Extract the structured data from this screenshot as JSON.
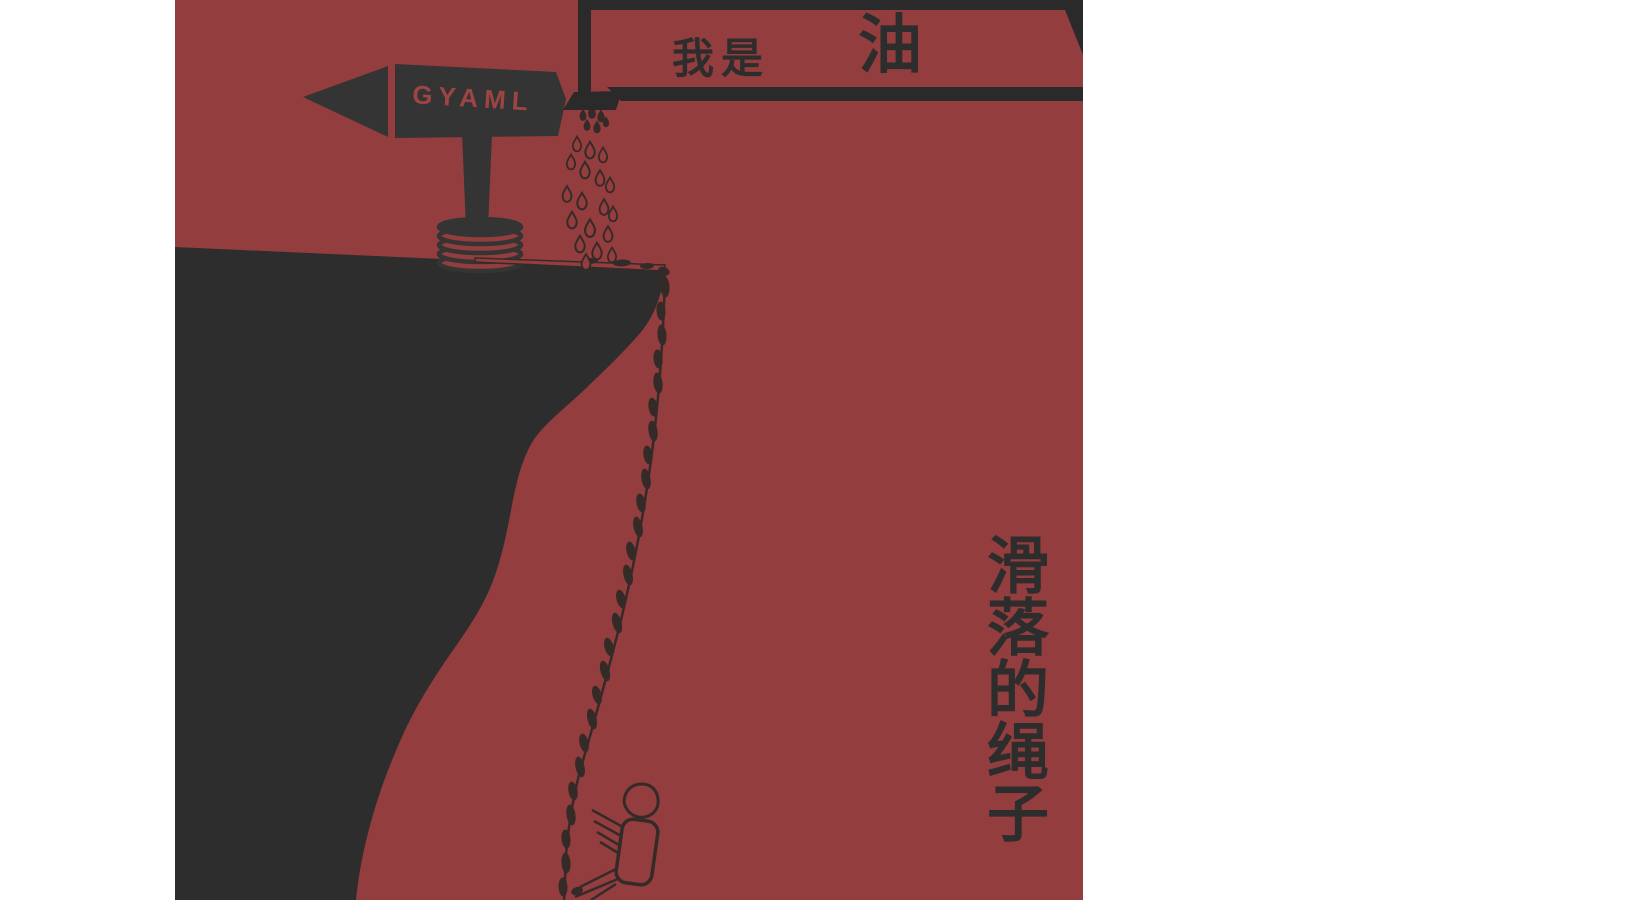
{
  "artwork": {
    "speech_bubble": {
      "prefix": "我是",
      "emphasis": "油"
    },
    "signpost": {
      "label": "GYAML",
      "label_color": "#9c4543"
    },
    "vertical_title": "滑落的绳子",
    "colors": {
      "page_background": "#ffffff",
      "panel_red": "#943d3e",
      "cliff_dark": "#2e2d2e",
      "sign_dark": "#343434",
      "bubble_dark": "#2a2a2a",
      "outline_dark": "#342b29"
    }
  }
}
